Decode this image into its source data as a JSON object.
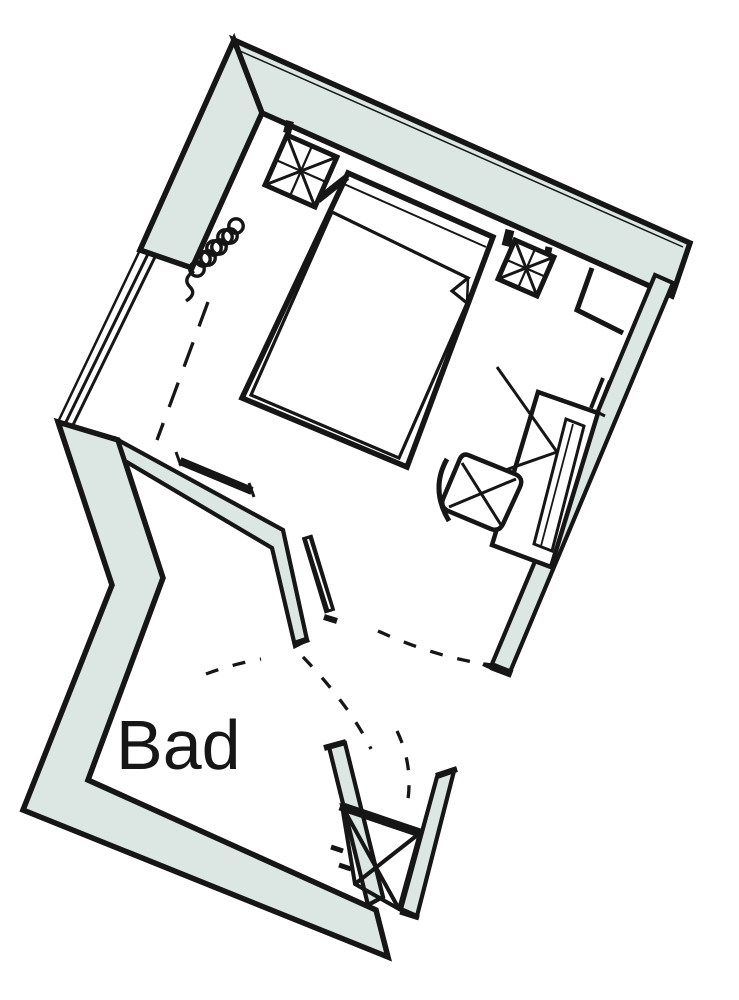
{
  "plan": {
    "room_label": "Bad",
    "colors": {
      "wall_fill": "#dce7e3",
      "line": "#161616",
      "background": "#ffffff"
    },
    "elements": {
      "bed": "double-bed",
      "desk": "desk",
      "chair": "chair",
      "radiator": "radiator-coil",
      "columns": "hatched-column",
      "shaft": "crossed-shaft-box",
      "doors": "door-swing-dashed",
      "window": "window-left"
    }
  }
}
